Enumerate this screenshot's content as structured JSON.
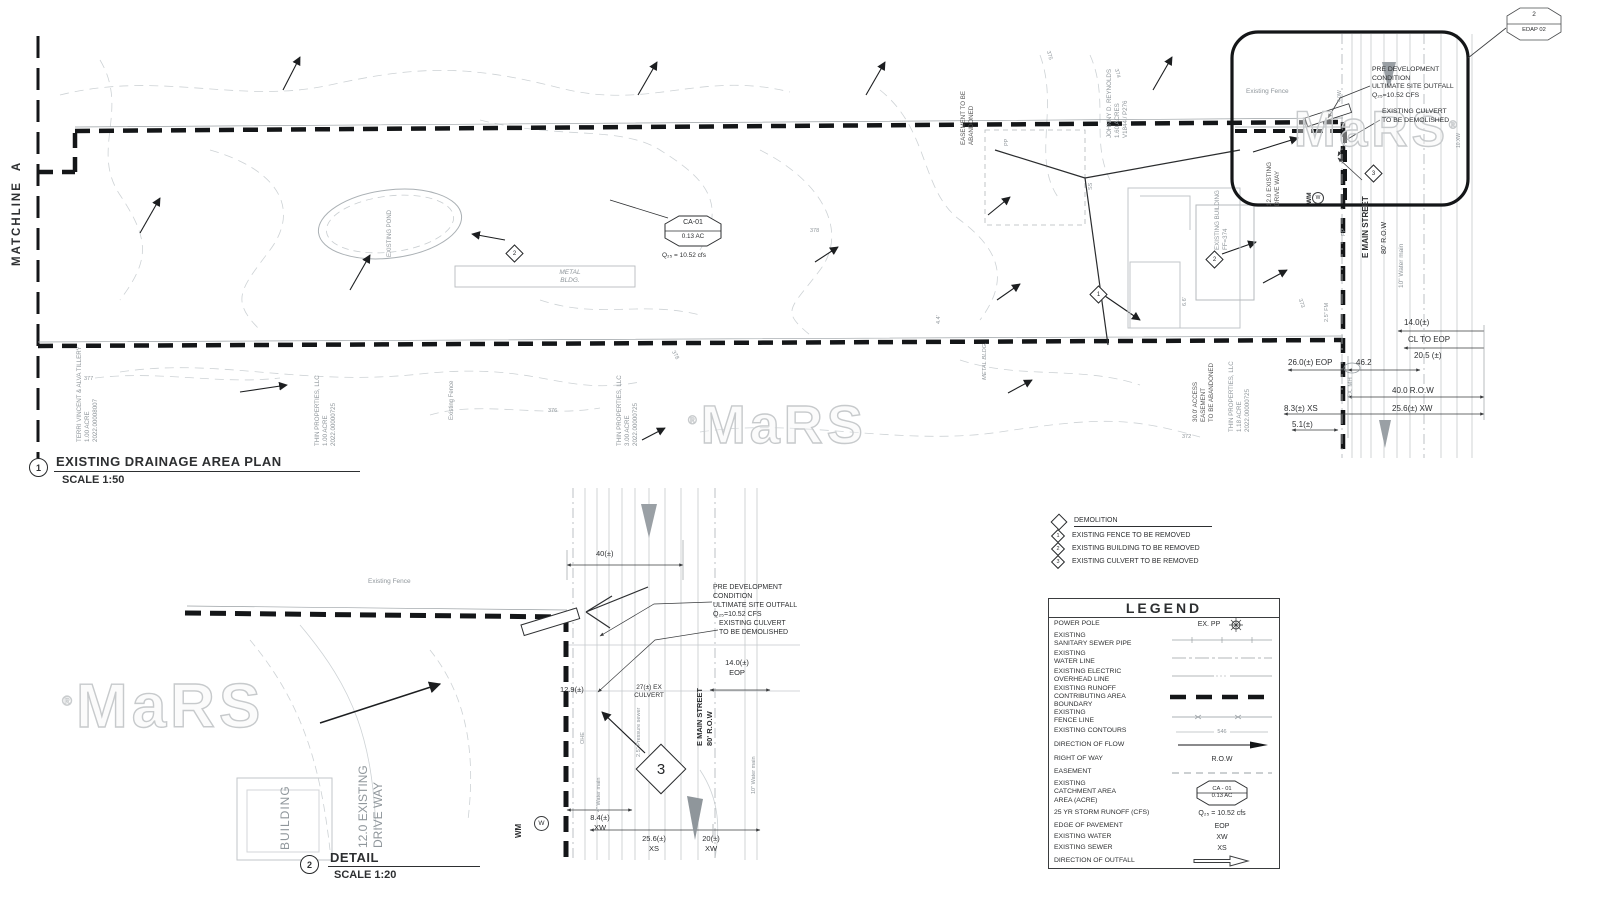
{
  "watermark": {
    "text": "MaRS",
    "reg": "®"
  },
  "ref_bubble": {
    "num": "2",
    "sheet": "EDAP 02"
  },
  "main_plan": {
    "matchline": "MATCHLINE  A",
    "title_num": "1",
    "title": "EXISTING DRAINAGE AREA PLAN",
    "scale": "SCALE 1:50",
    "pond": "EXISTING POND",
    "metal_bldg": "METAL\nBLDG.",
    "metal_bldg_2": "METAL BLDG.",
    "catchment": {
      "id": "CA-01",
      "area": "0.13 AC",
      "runoff": "Q₂₅ = 10.52 cfs"
    },
    "bubble": {
      "existing_fence": "Existing Fence",
      "pre_dev": "PRE DEVELOPMENT\nCONDITION\nULTIMATE SITE OUTFALL\nQ₂₅=10.52 CFS",
      "culvert": "EXISTING CULVERT\nTO BE DEMOLISHED",
      "driveway": "12.0 EXISTING\nDRIVE WAY",
      "wm": "WM",
      "wm_circle": "W",
      "diamond": "3"
    },
    "street": {
      "name": "E MAIN STREET",
      "row": "80' R.O.W",
      "water": "10\" Water main"
    },
    "props": {
      "tillery": "TERRI VINCENT & ALVA TILLERY\n1.00 ACRE\n2022.00008007",
      "thin1": "THIN PROPERTIES, LLC\n1.00 ACRE\n2022.00000725",
      "thin3": "THIN PROPERTIES, LLC\n3.00 ACRE\n2022.00000725",
      "thin118": "THIN PROPERTIES, LLC\n1.18 ACRE\n2022.00000725",
      "reynolds": "JOHNNY D. REYNOLDS\n1.60 ACRES\nV1844 / P276",
      "easement_abandoned": "EASEMENT TO BE\nABANDONED",
      "access_easement": "30.0' ACCESS\nEASEMENT\nTO BE ABANDONED"
    },
    "existing_fence": "Existing Fence",
    "existing_building": "EXISTING BUILDING\nFF=374",
    "dims": [
      "14.0(±)",
      "CL TO EOP",
      "20.5 (±)",
      "26.0(±) EOP",
      "46.2",
      "40.0 R.O.W",
      "8.3(±) XS",
      "25.6(±) XW",
      "5.1(±)"
    ],
    "tiny": {
      "pp": "PP",
      "ss": "SS",
      "len66": "6.6'",
      "len44": "4.4'",
      "fm": "2.5\" FM",
      "ex_mh": "EX. MH",
      "w40": "4.0W",
      "xw10": "10.XW"
    },
    "contours": [
      "375",
      "374",
      "377",
      "376",
      "378",
      "373",
      "372",
      "378"
    ],
    "diamonds": {
      "fence": "1",
      "building": "2",
      "metal": "2",
      "culvert": "3"
    }
  },
  "detail_plan": {
    "title_num": "2",
    "title": "DETAIL",
    "scale": "SCALE 1:20",
    "existing_fence": "Existing Fence",
    "dim_40": "40(±)",
    "pre_dev": "PRE DEVELOPMENT\nCONDITION\nULTIMATE SITE OUTFALL\nQ₂₅=10.52 CFS",
    "culvert": "EXISTING CULVERT\nTO BE DEMOLISHED",
    "dim_14": "14.0(±)\nEOP",
    "dim_129": "12.9(±)",
    "culvert_27": "27(±) EX\nCULVERT",
    "street": "E MAIN STREET\n80' R.O.W",
    "pressure_sewer": "2.5\" Pressure sewer",
    "water_4": "4\" Water main",
    "water_10": "10\" Water main",
    "ohe": "OHE",
    "wm": "WM",
    "wm_circle": "W",
    "diamond": "3",
    "dim_84": "8.4(±)\nXW",
    "dim_256": "25.6(±)\nXS",
    "dim_20": "20(±)\nXW",
    "building": "BUILDING",
    "driveway": "12.0 EXISTING\nDRIVE WAY"
  },
  "demolition": {
    "title": "DEMOLITION",
    "items": [
      {
        "num": "1",
        "label": "EXISTING FENCE TO BE REMOVED"
      },
      {
        "num": "2",
        "label": "EXISTING BUILDING TO BE REMOVED"
      },
      {
        "num": "3",
        "label": "EXISTING CULVERT TO BE REMOVED"
      }
    ]
  },
  "legend": {
    "title": "LEGEND",
    "rows": [
      {
        "label": "POWER POLE",
        "value": "EX. PP"
      },
      {
        "label": "EXISTING\nSANITARY SEWER PIPE",
        "value": ""
      },
      {
        "label": "EXISTING\nWATER LINE",
        "value": ""
      },
      {
        "label": "EXISTING ELECTRIC\nOVERHEAD LINE",
        "value": ""
      },
      {
        "label": "EXISTING RUNOFF\nCONTRIBUTING AREA\nBOUNDARY",
        "value": ""
      },
      {
        "label": "EXISTING\nFENCE LINE",
        "value": ""
      },
      {
        "label": "EXISTING CONTOURS",
        "value": "546"
      },
      {
        "label": "DIRECTION OF FLOW",
        "value": ""
      },
      {
        "label": "RIGHT OF WAY",
        "value": "R.O.W"
      },
      {
        "label": "EASEMENT",
        "value": ""
      },
      {
        "label": "EXISTING\nCATCHMENT AREA\nAREA (ACRE)",
        "value": "CA - 01\n0.13 AC"
      },
      {
        "label": "25 YR STORM RUNOFF (CFS)",
        "value": "Q₂₅ = 10.52 cfs"
      },
      {
        "label": "EDGE OF PAVEMENT",
        "value": "EOP"
      },
      {
        "label": "EXISTING WATER",
        "value": "XW"
      },
      {
        "label": "EXISTING SEWER",
        "value": "XS"
      },
      {
        "label": "DIRECTION OF OUTFALL",
        "value": ""
      }
    ]
  }
}
